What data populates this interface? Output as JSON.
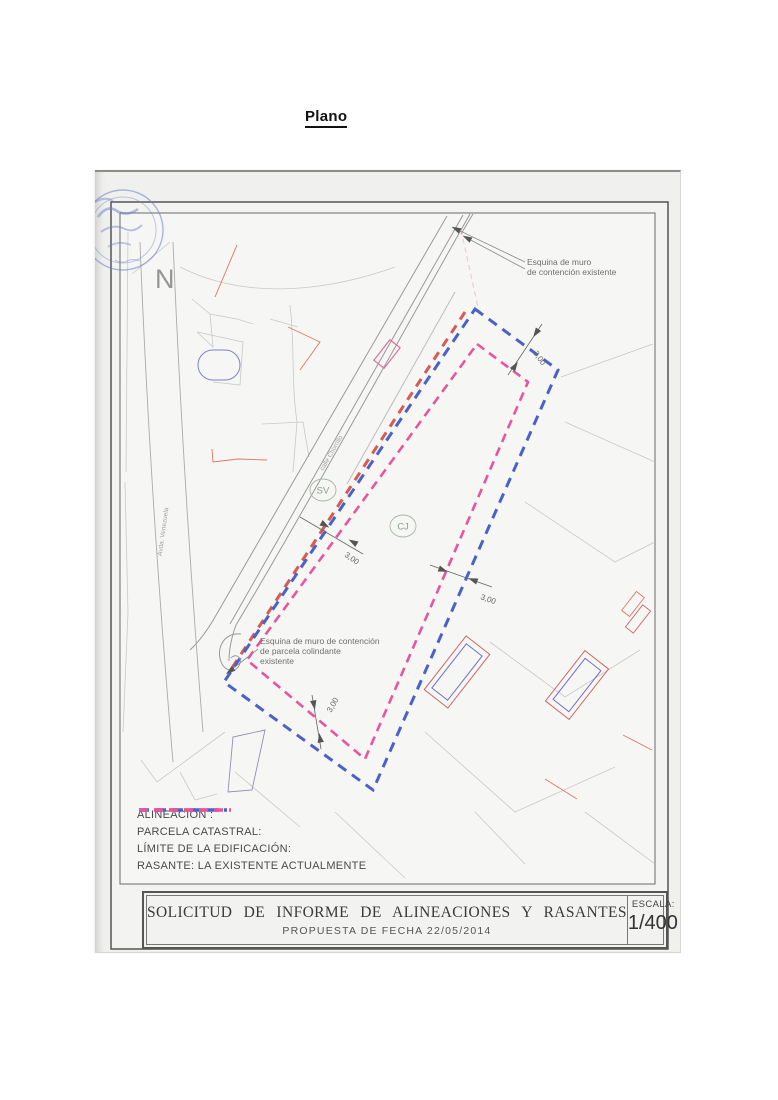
{
  "page": {
    "heading": "Plano"
  },
  "map": {
    "north": "N",
    "streets": {
      "street1": "calle Chorrillo",
      "street2": "Avda. Venezuela"
    },
    "zone_labels": {
      "sv": "SV",
      "cj": "CJ"
    },
    "notes": {
      "top_right_line1": "Esquina de muro",
      "top_right_line2": "de contención existente",
      "bottom_left_line1": "Esquina de muro de contención",
      "bottom_left_line2": "de parcela colindante",
      "bottom_left_line3": "existente"
    },
    "dimensions": {
      "d1": "3,00",
      "d2": "3,00",
      "d3": "3,00",
      "d4": "3,00"
    }
  },
  "legend": {
    "items": [
      {
        "label": "ALINEACIÓN :",
        "color": "#d85a50"
      },
      {
        "label": "PARCELA CATASTRAL:",
        "color": "#4a62c8"
      },
      {
        "label": "LÍMITE DE LA EDIFICACIÓN:",
        "color": "#e8559f"
      },
      {
        "label": "RASANTE: LA EXISTENTE ACTUALMENTE",
        "color": ""
      }
    ]
  },
  "title_block": {
    "title": "SOLICITUD DE INFORME DE ALINEACIONES Y RASANTES",
    "subtitle": "PROPUESTA DE FECHA 22/05/2014",
    "scale_label": "ESCALA:",
    "scale_value": "1/400"
  },
  "colors": {
    "alineacion": "#d85a50",
    "parcela_catastral": "#4a62c8",
    "limite_edificacion": "#e8559f",
    "rasante_note": "",
    "stamp_blue": "#6b7fc4"
  }
}
